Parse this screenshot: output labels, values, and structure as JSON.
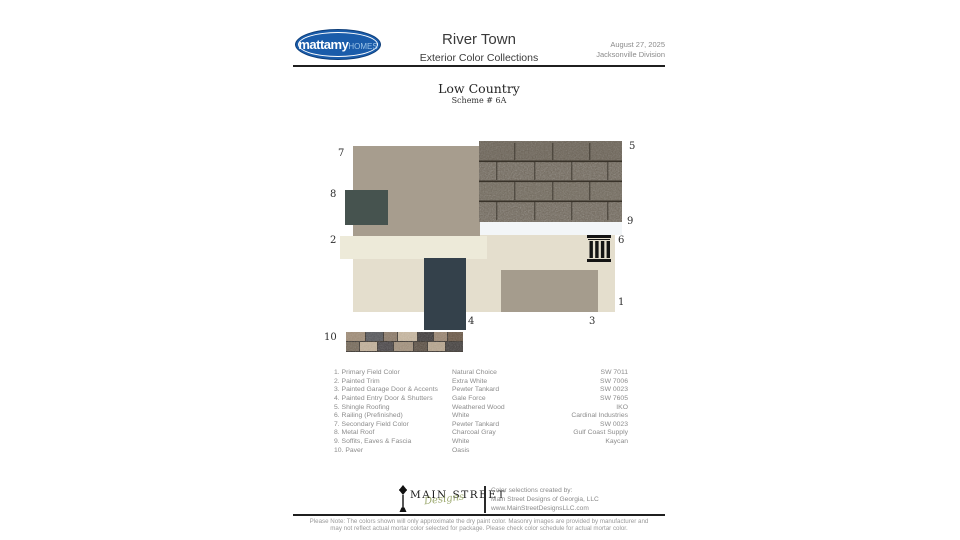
{
  "header": {
    "brand": "mattamy",
    "brand_suffix": "HOMES",
    "title": "River Town",
    "subtitle": "Exterior Color Collections",
    "date": "August 27, 2025",
    "division": "Jacksonville Division"
  },
  "scheme": {
    "name": "Low Country",
    "number": "Scheme # 6A"
  },
  "board": {
    "labels": {
      "l1": "1",
      "l2": "2",
      "l3": "3",
      "l4": "4",
      "l5": "5",
      "l6": "6",
      "l7": "7",
      "l8": "8",
      "l9": "9",
      "l10": "10"
    }
  },
  "colors": {
    "primary_field": "#e4decd",
    "painted_trim": "#edead9",
    "garage_door": "#a59c8d",
    "entry_door": "#34414b",
    "secondary_field": "#a79d8e",
    "metal_roof": "#46534f",
    "soffits": "#f3f6f8",
    "brand_blue": "#1a5caa",
    "rule_dark": "#1f1f1f"
  },
  "legend": {
    "rows": [
      {
        "item": "1. Primary Field Color",
        "color_name": "Natural Choice",
        "code": "SW 7011"
      },
      {
        "item": "2. Painted Trim",
        "color_name": "Extra White",
        "code": "SW 7006"
      },
      {
        "item": "3. Painted Garage Door & Accents",
        "color_name": "Pewter Tankard",
        "code": "SW 0023"
      },
      {
        "item": "4. Painted Entry Door & Shutters",
        "color_name": "Gale Force",
        "code": "SW 7605"
      },
      {
        "item": "5. Shingle Roofing",
        "color_name": "Weathered Wood",
        "code": "IKO"
      },
      {
        "item": "6. Railing (Prefinished)",
        "color_name": "White",
        "code": "Cardinal Industries"
      },
      {
        "item": "7. Secondary Field Color",
        "color_name": "Pewter Tankard",
        "code": "SW 0023"
      },
      {
        "item": "8. Metal Roof",
        "color_name": "Charcoal Gray",
        "code": "Gulf Coast Supply"
      },
      {
        "item": "9. Soffits, Eaves & Fascia",
        "color_name": "White",
        "code": "Kaycan"
      },
      {
        "item": "10. Paver",
        "color_name": "Oasis",
        "code": ""
      }
    ]
  },
  "footer": {
    "logo_words": "MAIN STREET",
    "logo_script": "Designs",
    "credit_line1": "Color selections created by:",
    "credit_line2": "Main Street Designs of Georgia, LLC",
    "credit_line3": "www.MainStreetDesignsLLC.com",
    "note": "Please Note: The colors shown will only approximate the dry paint color. Masonry images are provided by manufacturer and may not reflect actual mortar color selected for package. Please check color schedule for actual mortar color."
  }
}
